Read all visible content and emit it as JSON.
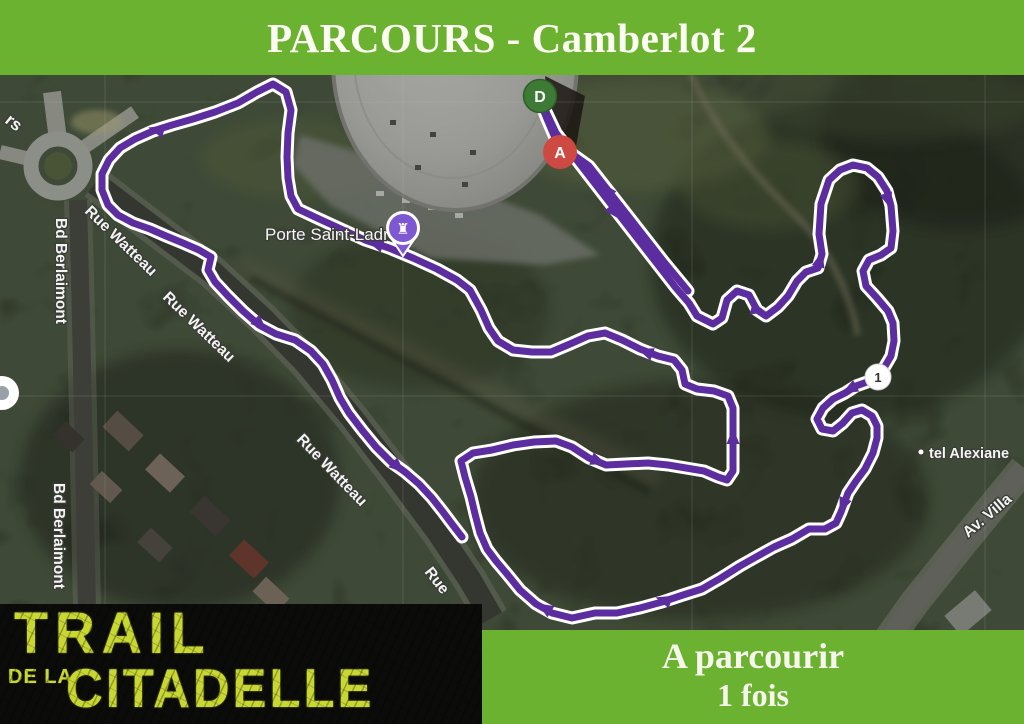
{
  "header": {
    "title": "PARCOURS - Camberlot 2",
    "bg_color": "#6ab22f",
    "text_color": "#fcfcf3"
  },
  "map": {
    "type": "satellite",
    "markers": {
      "start": "D",
      "finish": "A",
      "km1": "1"
    },
    "poi": {
      "porte_label": "Porte Saint-Ladre",
      "pin_glyph": "♜",
      "pin_color": "#7e57d2"
    },
    "streets": {
      "watteau": "Rue Watteau",
      "watteau_partial": "Rue",
      "berlaimont": "Bd Berlaimont",
      "hotel": "tel Alexiane",
      "avenue": "Av. Villa",
      "edge_partial": "rs"
    }
  },
  "route": {
    "color": "#5b2d9e",
    "casing_color": "#ffffff",
    "main_path": "M 540 99 L 556 133 L 593 181 L 641 243 L 676 288 L 689 303 L 697 316 L 713 324 L 722 318 L 727 300 L 737 291 L 749 295 L 757 310 L 766 316 L 778 307 L 788 296 L 797 281 L 806 272 L 818 268 L 822 254 L 819 234 L 821 204 L 829 180 L 840 170 L 853 165 L 867 168 L 878 177 L 887 191 L 891 206 L 893 231 L 891 248 L 881 255 L 869 260 L 863 271 L 866 286 L 877 298 L 888 311 L 893 323 L 894 341 L 891 356 L 884 368 L 876 377 L 867 382 L 856 386 L 845 393 L 833 399 L 823 408 L 817 419 L 822 429 L 833 431 L 843 423 L 852 413 L 862 410 L 872 416 L 877 426 L 877 438 L 873 453 L 865 469 L 856 481 L 848 493 L 841 512 L 836 523 L 825 529 L 809 529 L 792 539 L 774 547 L 756 557 L 740 566 L 721 578 L 702 589 L 683 595 L 662 602 L 640 608 L 617 613 L 595 613 L 572 618 L 552 613 L 536 604 L 520 590 L 507 574 L 496 561 L 487 549 L 480 533 L 475 514 L 471 497 L 465 477 L 461 461 L 473 453 L 492 450 L 513 445 L 534 442 L 556 441 L 572 447 L 589 458 L 606 465 L 626 464 L 648 463 L 668 465 L 686 468 L 704 471 L 718 477 L 727 480 L 733 471 L 733 450 L 733 427 L 733 408 L 728 396 L 714 391 L 697 389 L 685 384 L 682 370 L 674 360 L 658 356 L 640 349 L 622 340 L 605 333 L 588 336 L 570 344 L 551 352 L 532 352 L 513 350 L 498 341 L 489 328 L 481 310 L 470 290 L 457 280 L 437 269 L 413 258 L 389 248 L 365 240 L 341 229 L 317 218 L 298 209 L 291 196 L 288 178 L 287 157 L 288 133 L 291 110 L 286 92 L 273 84 L 257 92 L 238 103 L 215 112 L 193 119 L 172 125 L 153 131 L 135 139 L 120 148 L 109 160 L 102 174 L 102 190 L 108 205 L 118 215 L 133 223 L 150 229 L 166 236 L 183 243 L 199 250 L 211 257 L 208 270 L 215 282 L 228 296 L 243 311 L 259 325 L 276 334 L 295 340 L 311 351 L 323 364 L 332 380 L 340 398 L 349 413 L 362 430 L 376 447 L 391 462 L 405 472 L 419 484 L 432 498 L 443 512 L 452 524 L 462 537",
    "return_path": "M 688 291 L 664 262 L 625 212 L 589 166 L 568 151 L 556 140 L 547 119 L 541 104",
    "arrows": [
      [
        614,
        212,
        52
      ],
      [
        607,
        190,
        232
      ],
      [
        376,
        244,
        198
      ],
      [
        157,
        130,
        196
      ],
      [
        260,
        324,
        43
      ],
      [
        398,
        467,
        42
      ],
      [
        664,
        600,
        197
      ],
      [
        545,
        608,
        212
      ],
      [
        843,
        505,
        112
      ],
      [
        888,
        200,
        72
      ],
      [
        850,
        389,
        152
      ],
      [
        758,
        310,
        15
      ],
      [
        646,
        352,
        200
      ],
      [
        598,
        461,
        20
      ],
      [
        733,
        437,
        270
      ],
      [
        820,
        260,
        285
      ]
    ]
  },
  "logo": {
    "line1": "TRAIL",
    "line2": "DE LA",
    "line3": "CITADELLE",
    "text_color": "#c9d733"
  },
  "panel": {
    "line1": "A parcourir",
    "line2": "1 fois",
    "bg_color": "#6ab22f"
  }
}
